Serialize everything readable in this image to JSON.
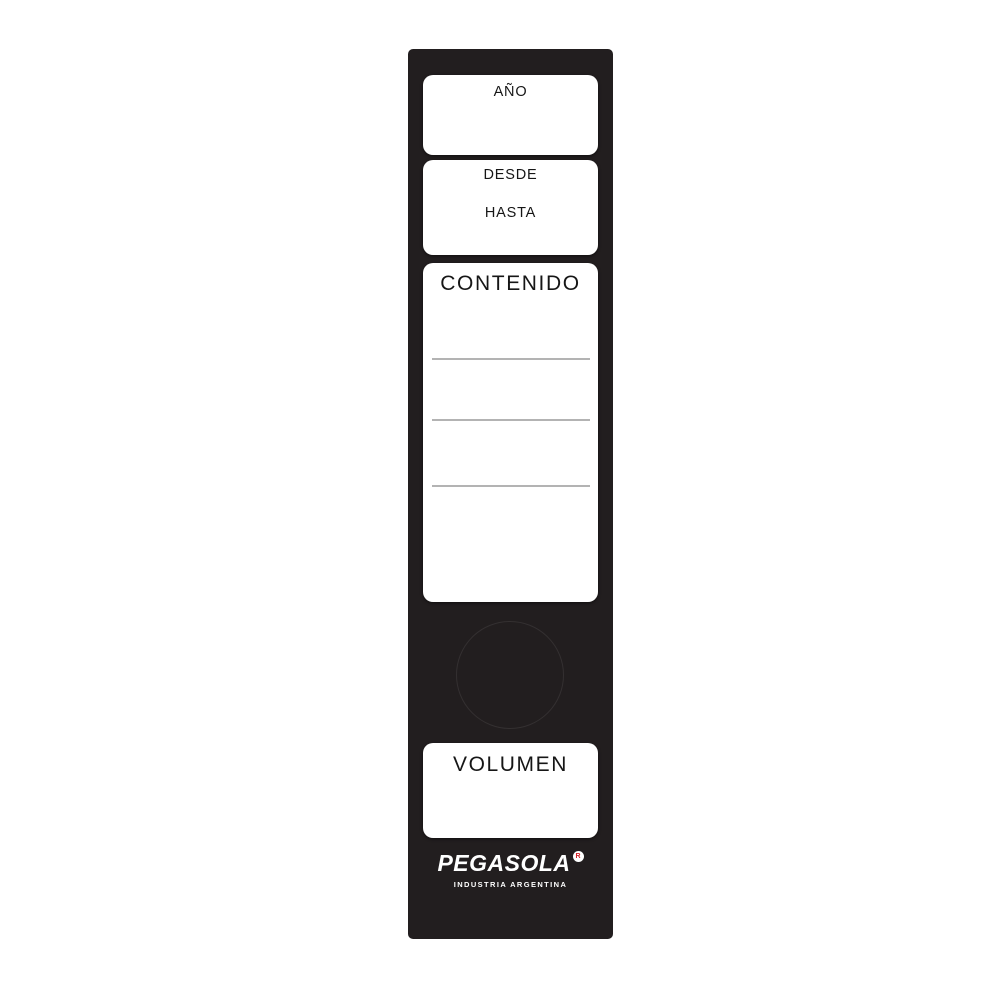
{
  "label": {
    "year": {
      "title": "AÑO"
    },
    "range": {
      "from": "DESDE",
      "to": "HASTA"
    },
    "content": {
      "title": "CONTENIDO",
      "ruled_lines": 3
    },
    "volume": {
      "title": "VOLUMEN"
    },
    "brand": {
      "name": "PEGASOLA",
      "registered": "R",
      "tagline": "INDUSTRIA ARGENTINA"
    },
    "colors": {
      "strip_black": "#221e1f",
      "panel_white": "#ffffff",
      "rule_gray": "#b3b3b3",
      "registered_red": "#d42027"
    }
  }
}
